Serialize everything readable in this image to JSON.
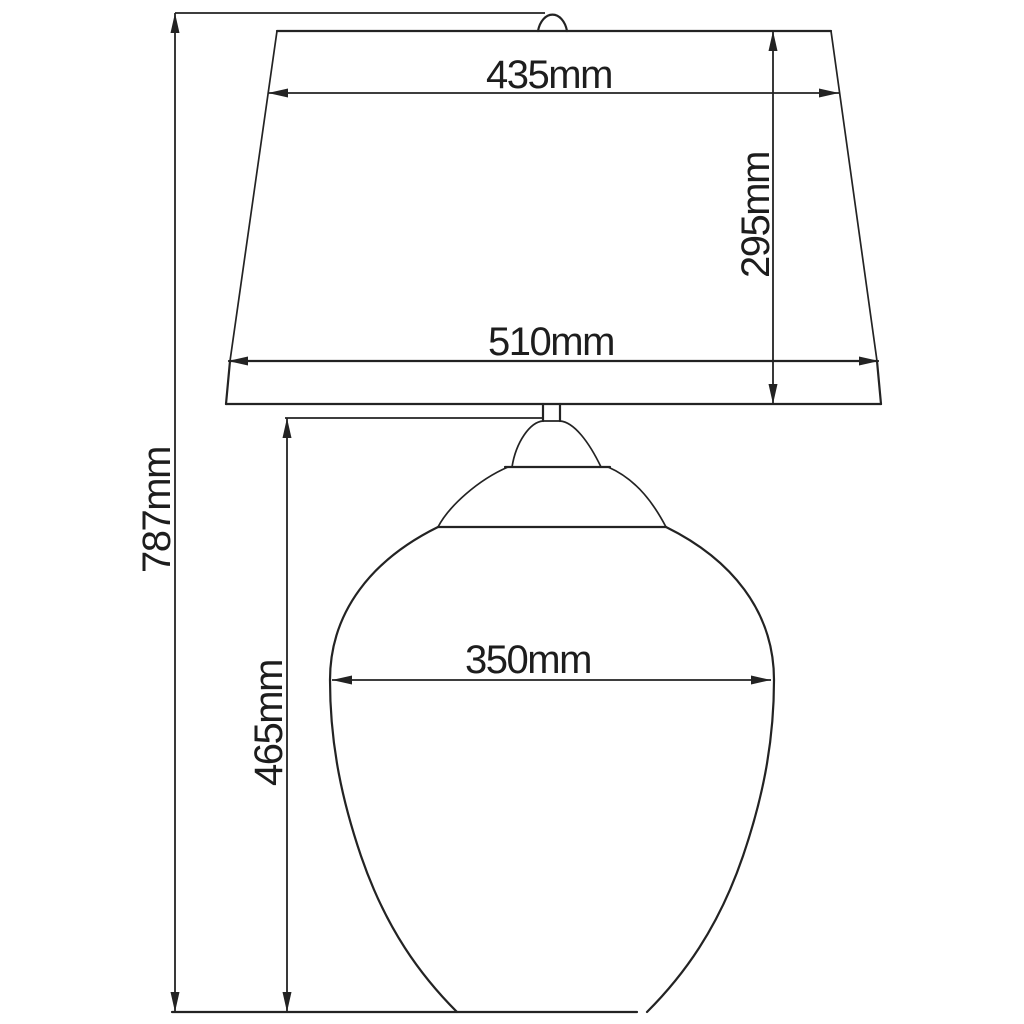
{
  "figure": {
    "type": "technical-dimension-diagram",
    "subject": "Table lamp with tapered shade and ovoid glass body, front elevation with dimension callouts",
    "units": "mm",
    "colors": {
      "background": "#ffffff",
      "line": "#232323"
    },
    "dimensions": {
      "shade_top_width": {
        "label": "435mm",
        "value": 435,
        "orientation": "horizontal"
      },
      "shade_height": {
        "label": "295mm",
        "value": 295,
        "orientation": "vertical"
      },
      "shade_bottom_width": {
        "label": "510mm",
        "value": 510,
        "orientation": "horizontal"
      },
      "overall_height": {
        "label": "787mm",
        "value": 787,
        "orientation": "vertical"
      },
      "body_height": {
        "label": "465mm",
        "value": 465,
        "orientation": "vertical"
      },
      "body_width": {
        "label": "350mm",
        "value": 350,
        "orientation": "horizontal"
      }
    }
  }
}
